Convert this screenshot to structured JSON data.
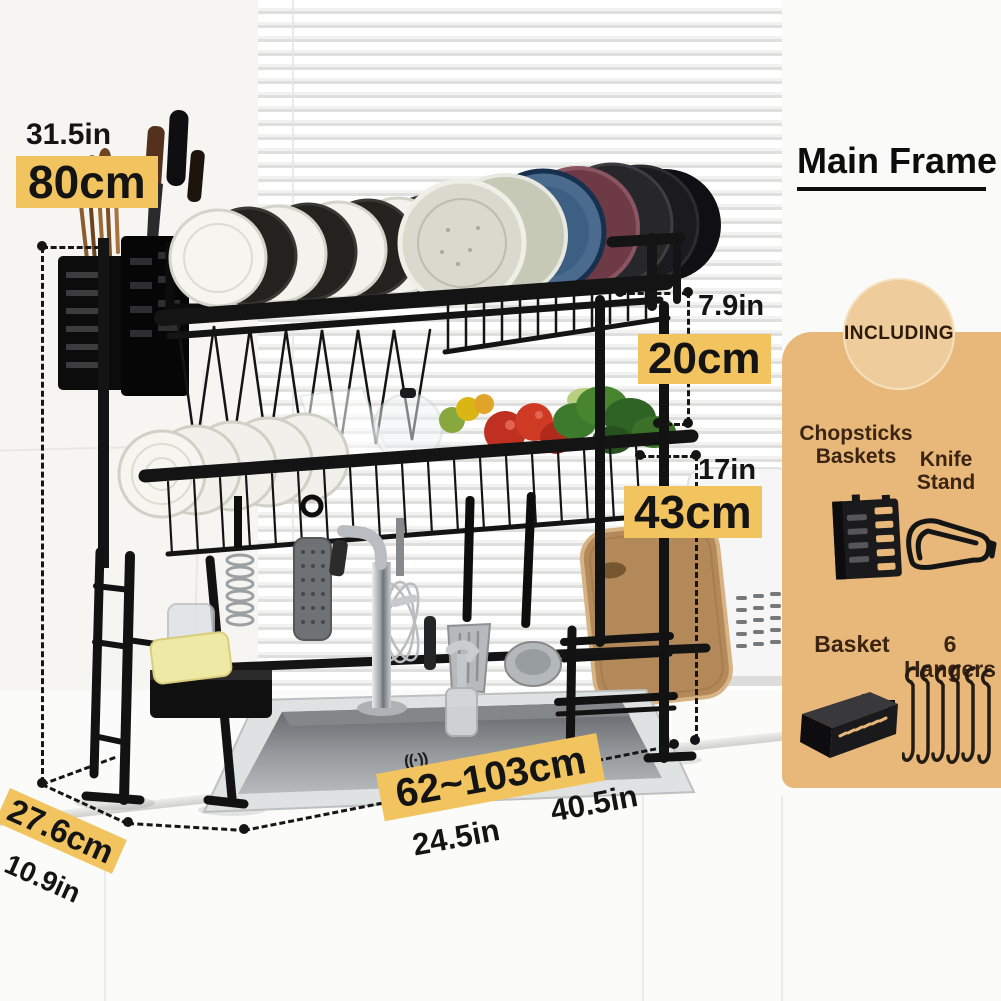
{
  "product_photo": {
    "description": "Black two-tier over-sink dish drying rack holding plates, bowls, vegetables and hanging utensils above a stainless kitchen sink",
    "sink_mark": "((·))"
  },
  "dimensions": {
    "height_in": "31.5in",
    "height_cm": "80cm",
    "tier_gap_in": "7.9in",
    "tier_gap_cm": "20cm",
    "lower_height_in": "17in",
    "lower_height_cm": "43cm",
    "width_cm": "62~103cm",
    "width_in_left": "24.5in",
    "width_in_right": "40.5in",
    "depth_cm": "27.6cm",
    "depth_in": "10.9in"
  },
  "side_panel": {
    "title": "Main Frame",
    "badge": "INCLUDING",
    "chopsticks_line1": "Chopsticks",
    "chopsticks_line2": "Baskets",
    "knife_stand": "Knife Stand",
    "basket": "Basket",
    "hangers": "6 Hangers"
  },
  "colors": {
    "highlight_yellow": "#F1C45F",
    "panel_tan": "#E8B87A",
    "badge_tan": "#EFCC9B",
    "annotation_black": "#141414",
    "panel_text_brown": "#3B2412"
  }
}
